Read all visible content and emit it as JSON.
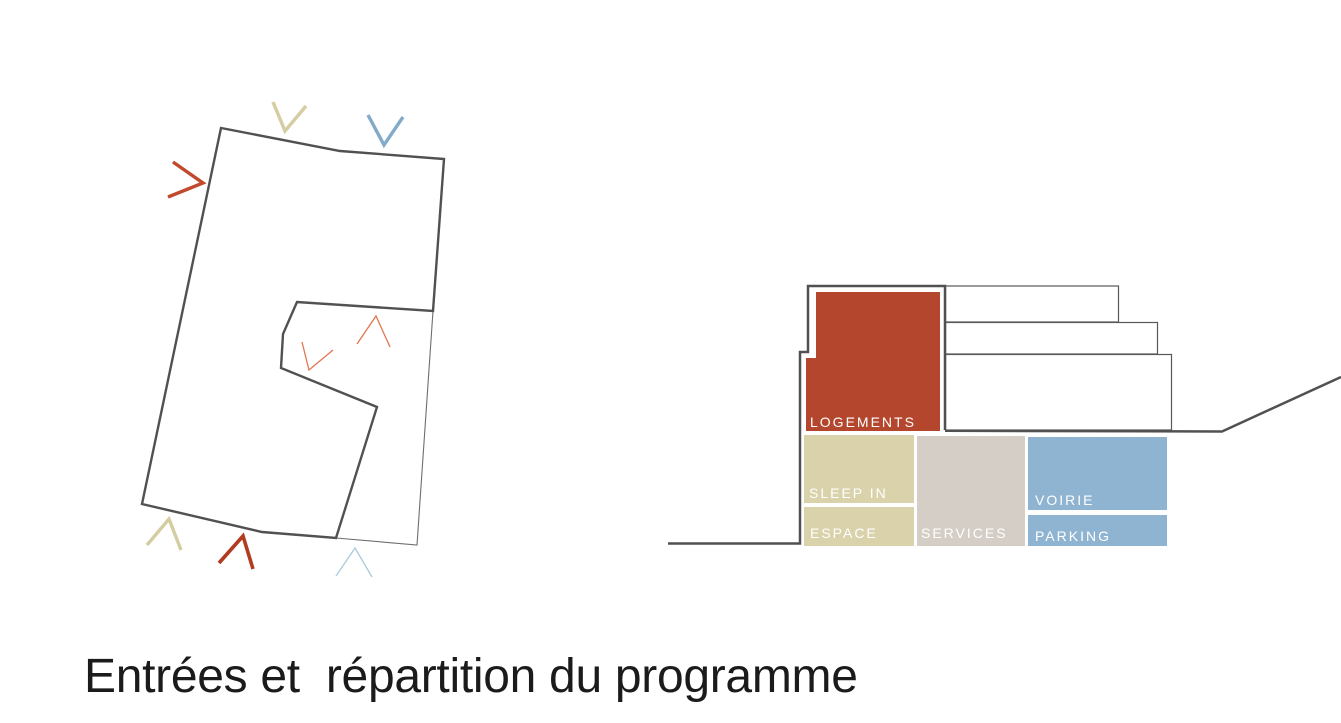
{
  "title": "Entrées et  répartition du programme",
  "colors": {
    "outline_dark": "#515153",
    "thin_line": "#6e6e70",
    "step_stroke": "#58585a",
    "label_white": "#ffffff",
    "title_color": "#1b1b1b"
  },
  "plan": {
    "name": "building-entrance-plan",
    "arrows": [
      {
        "id": "entrance-arrow-west-red",
        "color": "#c14a2c",
        "weight": "thick"
      },
      {
        "id": "entrance-arrow-north-tan",
        "color": "#d5cda2",
        "weight": "thick"
      },
      {
        "id": "entrance-arrow-north-blue",
        "color": "#82aac9",
        "weight": "thick"
      },
      {
        "id": "courtyard-arrow-orange-up",
        "color": "#e1764f",
        "weight": "thin"
      },
      {
        "id": "courtyard-arrow-orange-down",
        "color": "#e1764f",
        "weight": "thin"
      },
      {
        "id": "entrance-arrow-south-tan",
        "color": "#d5cda2",
        "weight": "thick"
      },
      {
        "id": "entrance-arrow-south-red",
        "color": "#b23c1f",
        "weight": "thick"
      },
      {
        "id": "entrance-arrow-south-lightblue",
        "color": "#abcbdd",
        "weight": "thin"
      }
    ]
  },
  "section": {
    "name": "program-distribution-section",
    "blocks": [
      {
        "id": "logements",
        "label": "LOGEMENTS",
        "color": "#b4462d"
      },
      {
        "id": "sleep-in",
        "label": "SLEEP IN",
        "color": "#d9d2aa"
      },
      {
        "id": "espace",
        "label": "ESPACE",
        "color": "#d9d2aa"
      },
      {
        "id": "services",
        "label": "SERVICES",
        "color": "#d5cec6"
      },
      {
        "id": "voirie",
        "label": "VOIRIE",
        "color": "#8fb4d1"
      },
      {
        "id": "parking",
        "label": "PARKING",
        "color": "#8fb4d1"
      }
    ]
  }
}
